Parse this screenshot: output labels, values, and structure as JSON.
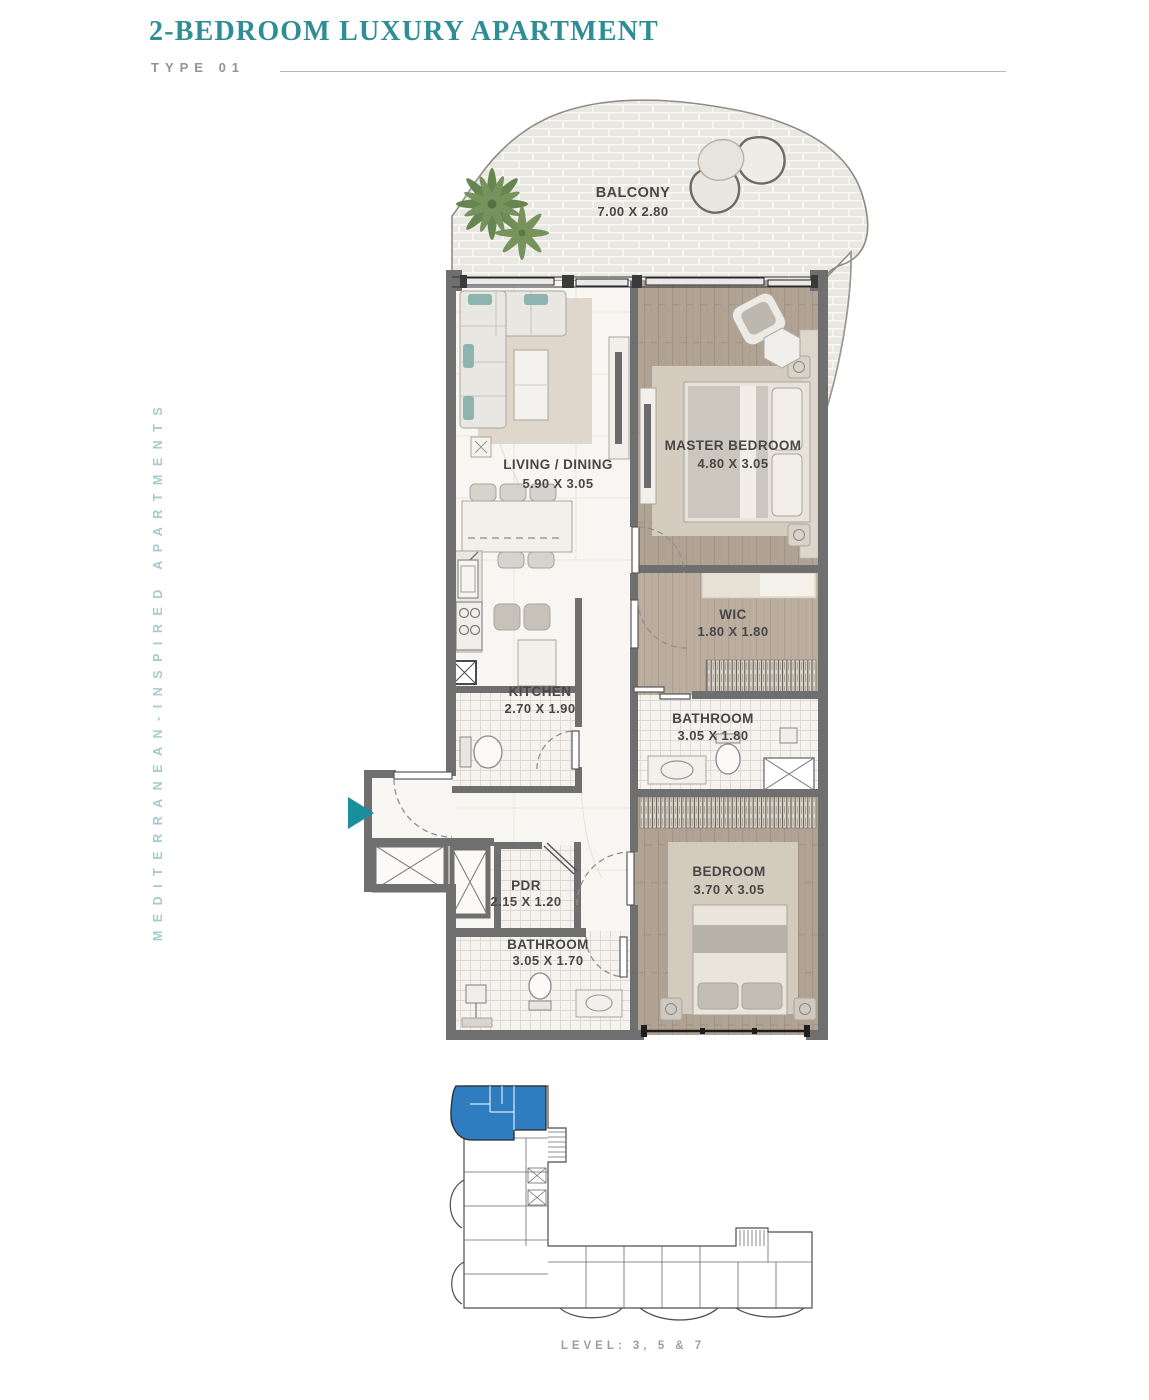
{
  "header": {
    "title": "2-BEDROOM LUXURY APARTMENT",
    "type_label": "TYPE 01"
  },
  "side_label": "MEDITERRANEAN-INSPIRED APARTMENTS",
  "rooms": {
    "balcony": {
      "name": "BALCONY",
      "dims": "7.00 X 2.80"
    },
    "living": {
      "name": "LIVING / DINING",
      "dims": "5.90 X 3.05"
    },
    "master": {
      "name": "MASTER BEDROOM",
      "dims": "4.80 X 3.05"
    },
    "wic": {
      "name": "WIC",
      "dims": "1.80 X 1.80"
    },
    "kitchen": {
      "name": "KITCHEN",
      "dims": "2.70 X 1.90"
    },
    "bathroom1": {
      "name": "BATHROOM",
      "dims": "3.05 X 1.80"
    },
    "pdr": {
      "name": "PDR",
      "dims": "2.15 X 1.20"
    },
    "bathroom2": {
      "name": "BATHROOM",
      "dims": "3.05 X 1.70"
    },
    "bedroom2": {
      "name": "BEDROOM",
      "dims": "3.70 X 3.05"
    }
  },
  "key_plan": {
    "level_label": "LEVEL: 3, 5 & 7"
  },
  "colors": {
    "accent_teal": "#2f8d96",
    "side_label_teal": "#a6cad0",
    "entrance_arrow_teal": "#1b8e9d",
    "unit_highlight_blue": "#2e7dc1",
    "wall_gray": "#6f6f6f",
    "wood_floor": "#b0a294",
    "balcony_stone": "#e9e7e1",
    "level_label_gray": "#9a9ea1"
  }
}
